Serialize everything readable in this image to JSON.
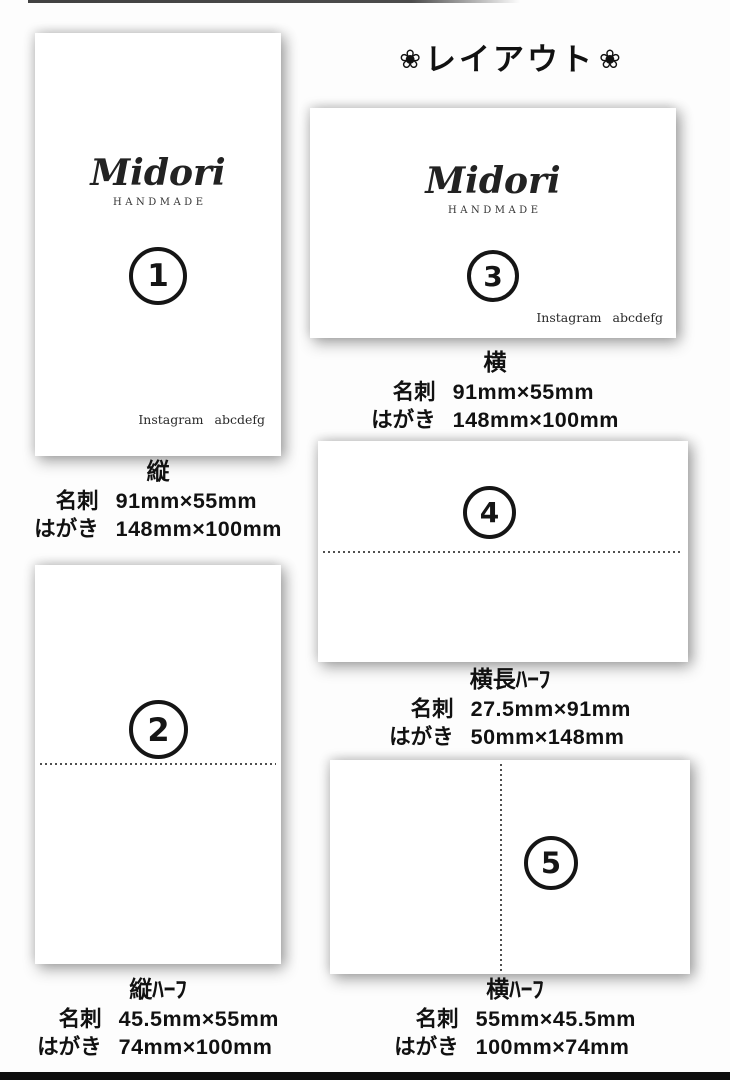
{
  "title": {
    "flower_left": "❀",
    "text": "レイアウト",
    "flower_right": "❀"
  },
  "brand": {
    "name": "Midori",
    "subtitle": "HANDMADE",
    "instagram_label": "Instagram",
    "instagram_handle": "abcdefg"
  },
  "cards": [
    {
      "number": "1",
      "orientation": "縦",
      "meishi_label": "名刺",
      "meishi_size": "91mm×55mm",
      "hagaki_label": "はがき",
      "hagaki_size": "148mm×100mm"
    },
    {
      "number": "2",
      "orientation": "縦ﾊｰﾌ",
      "meishi_label": "名刺",
      "meishi_size": "45.5mm×55mm",
      "hagaki_label": "はがき",
      "hagaki_size": "74mm×100mm"
    },
    {
      "number": "3",
      "orientation": "横",
      "meishi_label": "名刺",
      "meishi_size": "91mm×55mm",
      "hagaki_label": "はがき",
      "hagaki_size": "148mm×100mm"
    },
    {
      "number": "4",
      "orientation": "横長ﾊｰﾌ",
      "meishi_label": "名刺",
      "meishi_size": "27.5mm×91mm",
      "hagaki_label": "はがき",
      "hagaki_size": "50mm×148mm"
    },
    {
      "number": "5",
      "orientation": "横ﾊｰﾌ",
      "meishi_label": "名刺",
      "meishi_size": "55mm×45.5mm",
      "hagaki_label": "はがき",
      "hagaki_size": "100mm×74mm"
    }
  ],
  "colors": {
    "ink": "#1a1a1a",
    "card_bg": "#ffffff",
    "page_bg": "#fdfdfd",
    "fold_line": "#4f4f4f",
    "bottom_bar": "#0e0e0e"
  }
}
